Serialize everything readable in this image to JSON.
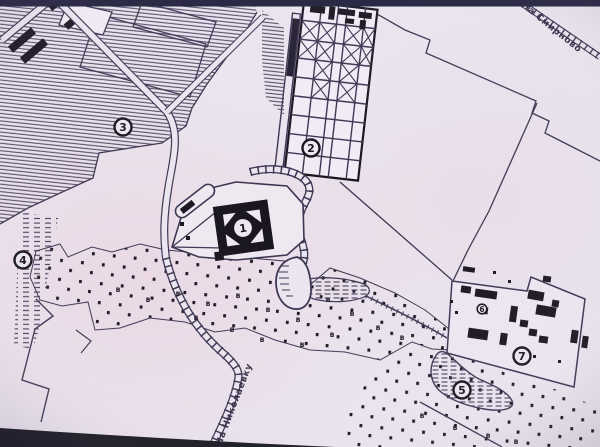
{
  "map": {
    "markers": [
      {
        "label": "1"
      },
      {
        "label": "2"
      },
      {
        "label": "3"
      },
      {
        "label": "4"
      },
      {
        "label": "5"
      },
      {
        "label": "6"
      },
      {
        "label": "7"
      }
    ],
    "road_labels": {
      "top_right": "На Смирново",
      "bottom": "На Николаевку"
    },
    "field_symbol": "в",
    "colors": {
      "paper": "#eae5ef",
      "ink": "#3a3450",
      "black": "#17131f",
      "photo_border": "#20203c"
    }
  }
}
